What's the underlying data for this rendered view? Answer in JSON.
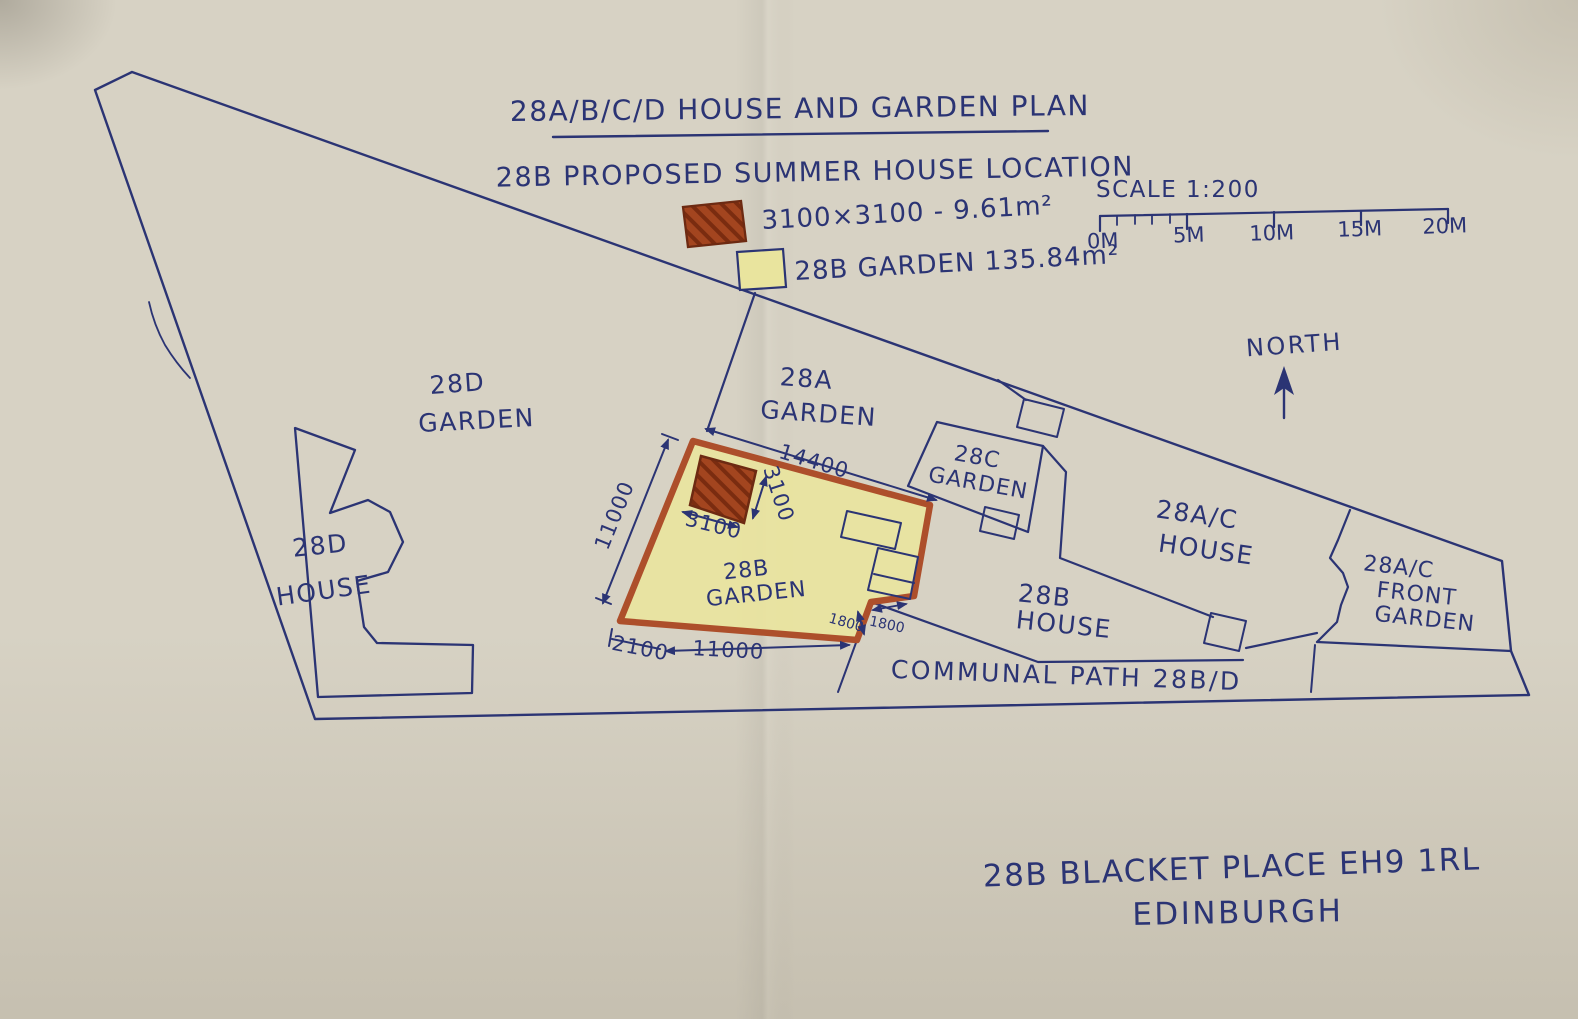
{
  "colors": {
    "paper": "#d7d2c4",
    "ink": "#2b3474",
    "marker_orange": "#ad4f2b",
    "garden_yellow": "#e9e49e",
    "brick_red": "#a3451f",
    "brick_dark": "#7a2c10"
  },
  "title": {
    "main": "28A/B/C/D HOUSE AND GARDEN PLAN",
    "sub": "28B PROPOSED SUMMER HOUSE LOCATION"
  },
  "legend": {
    "summer_house_label": "3100×3100 - 9.61m²",
    "garden_label": "28B GARDEN 135.84m²"
  },
  "scale_bar": {
    "label": "SCALE 1:200",
    "ticks": [
      "0M",
      "5M",
      "10M",
      "15M",
      "20M"
    ]
  },
  "compass": {
    "label": "NORTH"
  },
  "areas": {
    "d_garden": [
      "28D",
      "GARDEN"
    ],
    "d_house": [
      "28D",
      "HOUSE"
    ],
    "a_garden": [
      "28A",
      "GARDEN"
    ],
    "b_garden": [
      "28B",
      "GARDEN"
    ],
    "c_garden": [
      "28C",
      "GARDEN"
    ],
    "ac_house": [
      "28A/C",
      "HOUSE"
    ],
    "ac_front_garden": [
      "28A/C",
      "FRONT",
      "GARDEN"
    ],
    "b_house": [
      "28B",
      "HOUSE"
    ],
    "communal_path": "COMMUNAL PATH 28B/D"
  },
  "dimensions": {
    "garden_top": "14400",
    "garden_left": "11000",
    "summer_w": "3100",
    "summer_h": "3100",
    "offset": "2100",
    "garden_bottom": "11000",
    "notch_v": "1800",
    "notch_h": "1800"
  },
  "address": {
    "line1": "28B BLACKET PLACE EH9 1RL",
    "line2": "EDINBURGH"
  }
}
